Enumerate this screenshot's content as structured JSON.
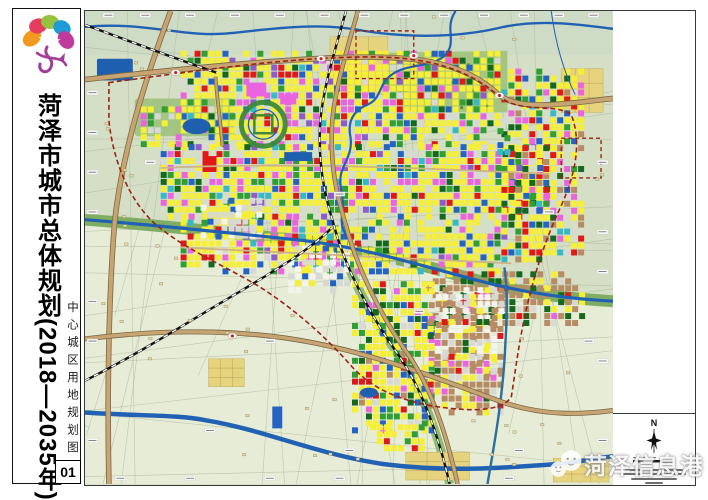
{
  "sidebar": {
    "title": "菏泽市城市总体规划(2018—2035年)",
    "subtitle": "中心城区用地规划图",
    "page_number": "01",
    "logo_name": "heze-peony-logo"
  },
  "right_panel": {
    "north_label": "N"
  },
  "watermark": {
    "text": "菏泽信息港"
  },
  "map": {
    "base_north": "#d4dfc6",
    "base_south": "#e6ecd6",
    "palette": {
      "Y": "#f6ef34",
      "R": "#e01818",
      "M": "#ea64df",
      "G": "#2f9e33",
      "D": "#15691f",
      "B": "#2363c4",
      "N": "#d9d9d4",
      "W": "#f4f4ef",
      "P": "#8f5bc8",
      "I": "#b78c64",
      "C": "#35b8c8",
      "O": "#eda32d"
    },
    "water_color": "#2161b3",
    "road_tan": "#c7a472",
    "road_casing": "#7a6a45",
    "boundary_red": "#9c2313",
    "park_green": "#a3c37c",
    "corridor_green": "#7fae62",
    "town_tan": "#e6d37e"
  }
}
